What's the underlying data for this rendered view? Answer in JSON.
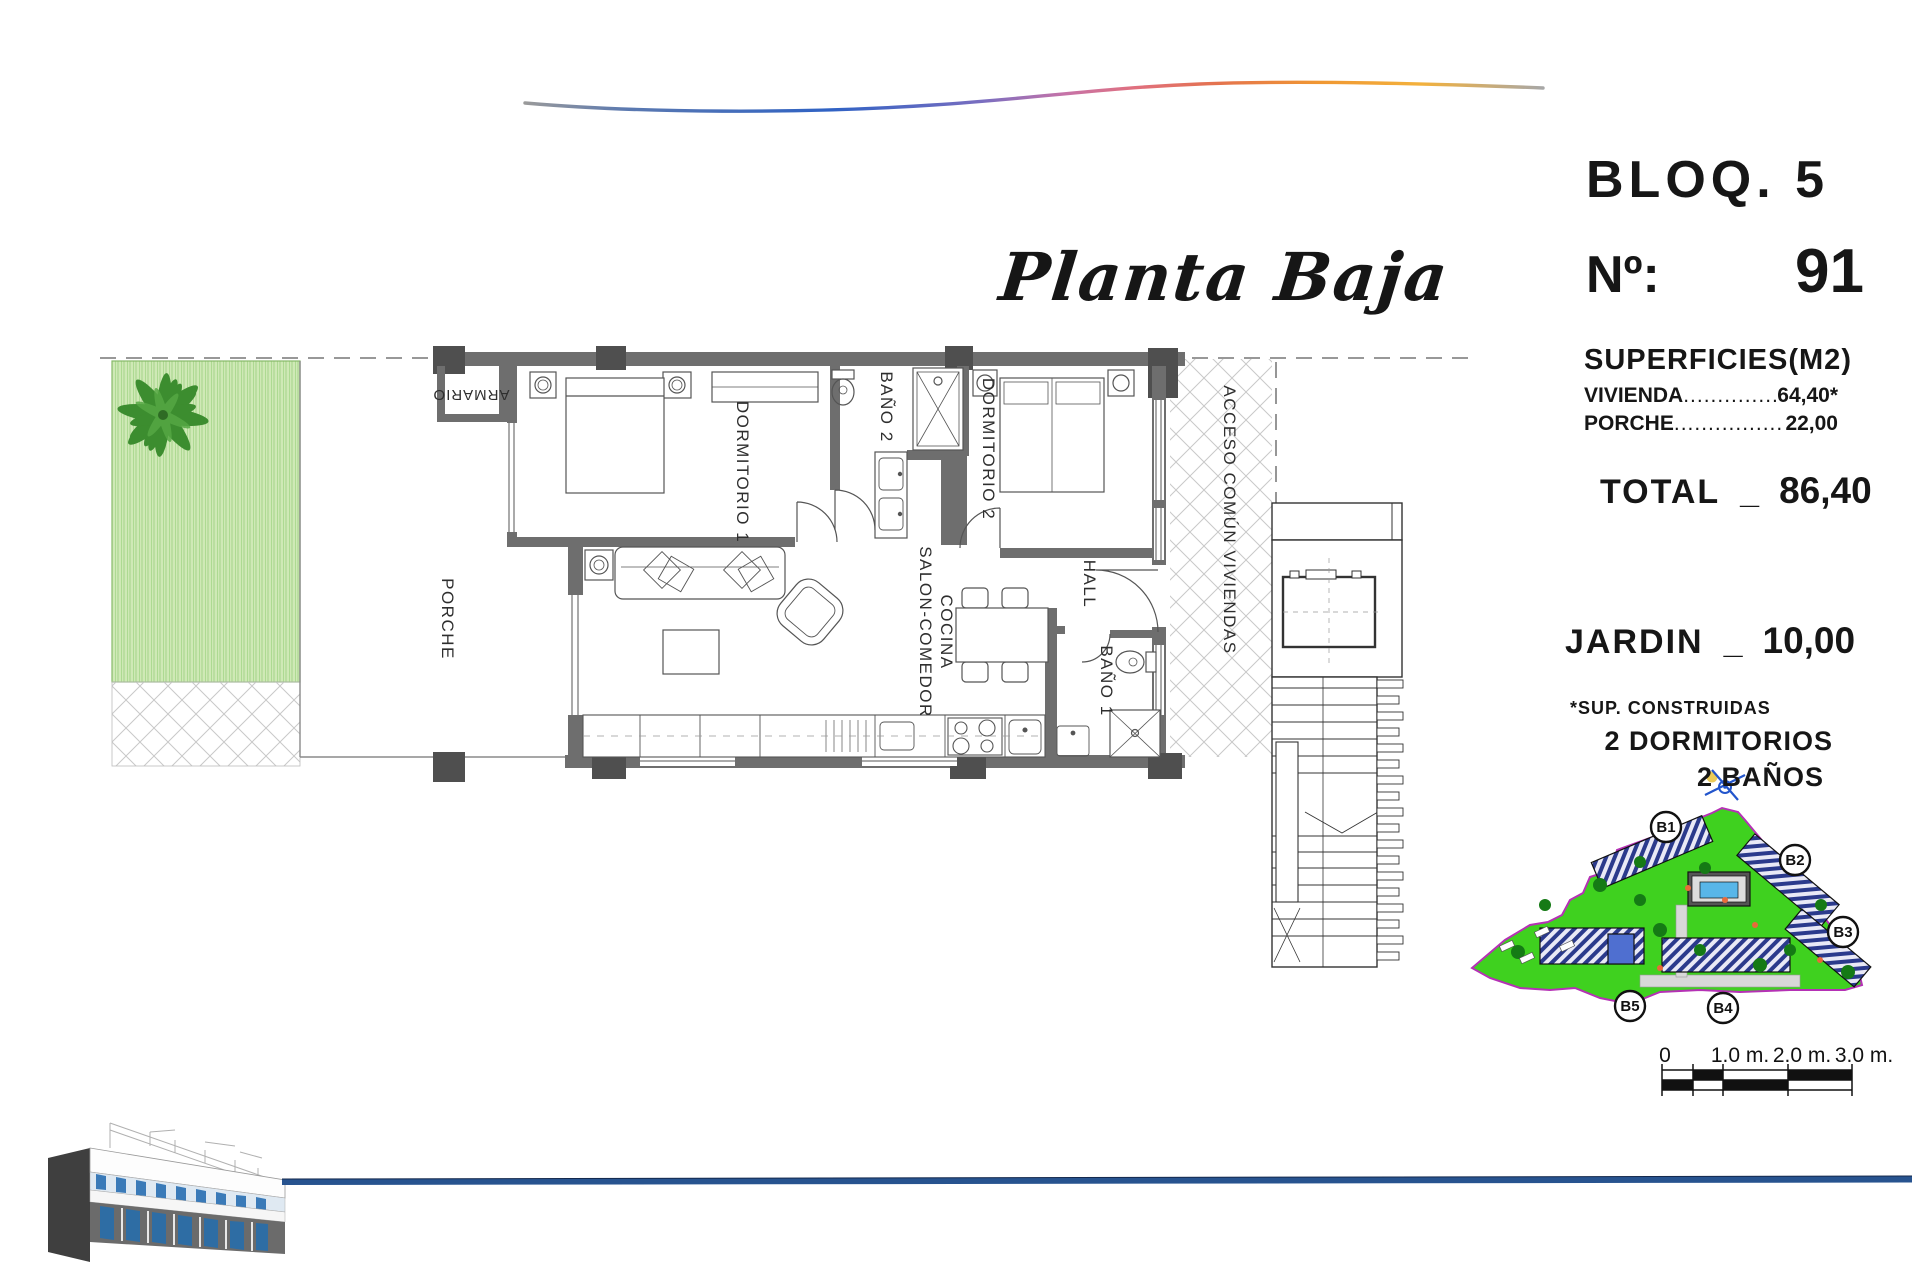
{
  "title": "Planta Baja",
  "info_panel": {
    "block": "BLOQ. 5",
    "unit_label": "Nº:",
    "unit_number": "91",
    "surfaces_heading": "SUPERFICIES(M2)",
    "surface_rows": [
      {
        "label": "VIVIENDA",
        "dots": "......................................",
        "value": "64,40*"
      },
      {
        "label": "PORCHE",
        "dots": "......................................",
        "value": "22,00"
      }
    ],
    "total": {
      "label": "TOTAL",
      "separator": "_",
      "value": "86,40"
    },
    "jardin": {
      "label": "JARDIN",
      "separator": "_",
      "value": "10,00"
    },
    "footnote": "*SUP. CONSTRUIDAS",
    "features": {
      "bedrooms": "2 DORMITORIOS",
      "bathrooms": "2 BAÑOS"
    }
  },
  "floor_plan": {
    "labels": {
      "porche": "PORCHE",
      "armario": "ARMARIO",
      "dormitorio1": "DORMITORIO 1",
      "bano2": "BAÑO 2",
      "dormitorio2": "DORMITORIO 2",
      "salon_line1": "SALON-COMEDOR",
      "salon_line2": "COCINA",
      "hall": "HALL",
      "bano1": "BAÑO 1",
      "acceso": "ACCESO COMÚN VIVIENDAS"
    }
  },
  "site_map": {
    "block_labels": [
      "B1",
      "B2",
      "B3",
      "B4",
      "B5"
    ]
  },
  "scale_bar": {
    "tick_labels": [
      "0",
      "1.0 m.",
      "2.0 m.",
      "3.0 m."
    ]
  },
  "colors": {
    "wall": "#6e6e6e",
    "garden_green": "#cfe9b6",
    "site_green": "#3fd11f",
    "site_border": "#b531b5",
    "accent_blue_line": "#27538f",
    "roof_blue": "#2b3a8c"
  }
}
